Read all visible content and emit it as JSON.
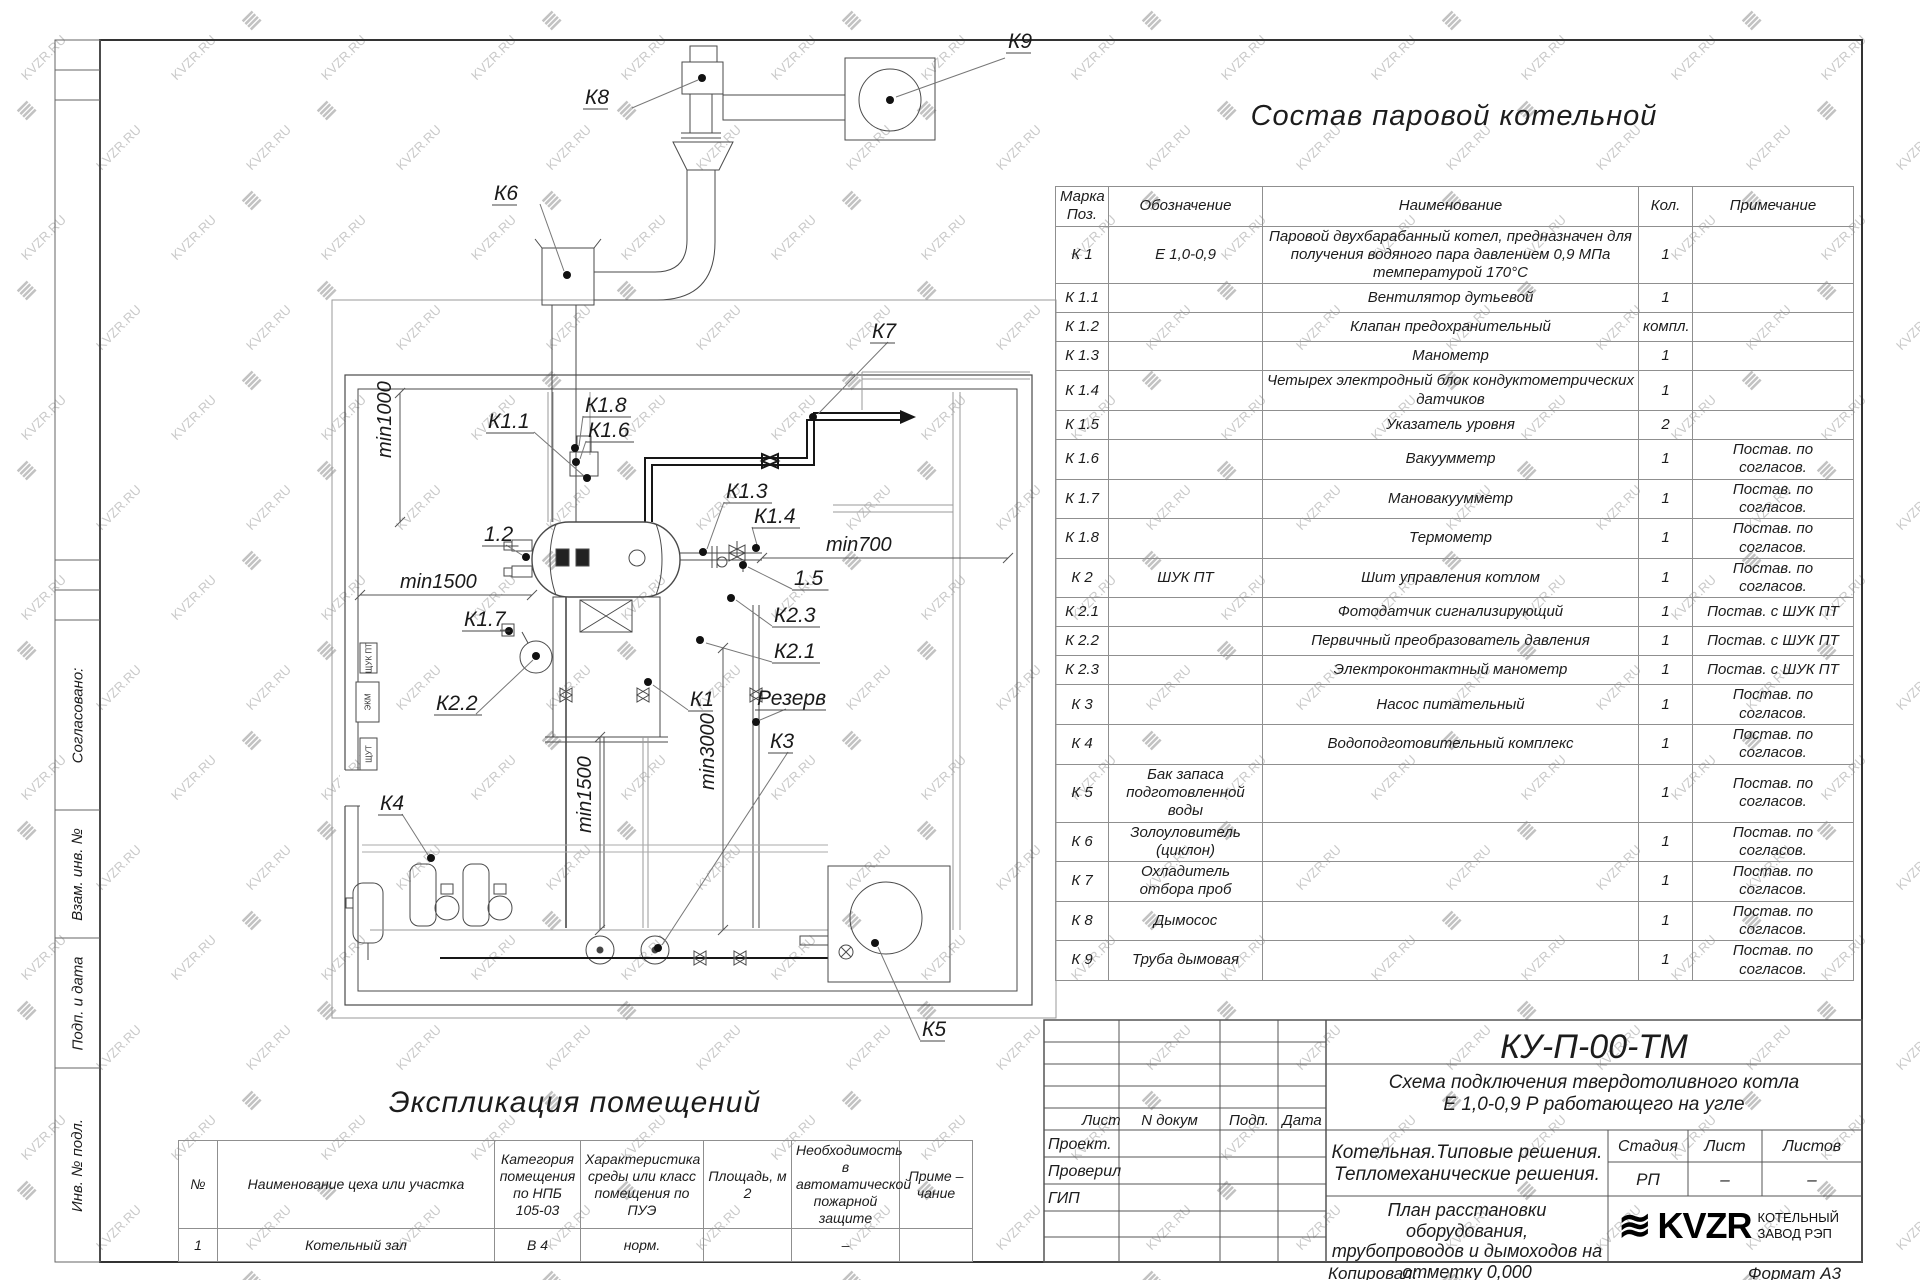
{
  "watermark": {
    "text": "KVZR.RU",
    "glyph": "≣"
  },
  "frame": {
    "left_strip": [
      {
        "label": "Согласовано:",
        "top": 620,
        "h": 190
      },
      {
        "label": "Взам. инв. №",
        "top": 810,
        "h": 128
      },
      {
        "label": "Подп. и дата",
        "top": 938,
        "h": 130
      },
      {
        "label": "Инв. № подл.",
        "top": 1068,
        "h": 194
      }
    ]
  },
  "plan": {
    "callouts": [
      {
        "label": "К9",
        "x": 1008,
        "y": 48,
        "leader": [
          [
            1005,
            58
          ],
          [
            896,
            97
          ]
        ],
        "dot": [
          890,
          100
        ]
      },
      {
        "label": "К8",
        "x": 585,
        "y": 104,
        "leader": [
          [
            632,
            108
          ],
          [
            698,
            80
          ]
        ],
        "dot": [
          702,
          78
        ]
      },
      {
        "label": "К6",
        "x": 494,
        "y": 200,
        "leader": [
          [
            540,
            204
          ],
          [
            564,
            271
          ]
        ],
        "dot": [
          567,
          275
        ]
      },
      {
        "label": "К7",
        "x": 872,
        "y": 338,
        "leader": [
          [
            888,
            342
          ],
          [
            818,
            414
          ]
        ],
        "dot": [
          813,
          417
        ]
      },
      {
        "label": "К1.8",
        "x": 585,
        "y": 412,
        "leader": [
          [
            583,
            416
          ],
          [
            579,
            446
          ]
        ],
        "dot": [
          575,
          448
        ]
      },
      {
        "label": "К1.6",
        "x": 588,
        "y": 437,
        "leader": [
          [
            586,
            441
          ],
          [
            580,
            459
          ]
        ],
        "dot": [
          576,
          462
        ]
      },
      {
        "label": "К1.1",
        "x": 488,
        "y": 428,
        "leader": [
          [
            534,
            432
          ],
          [
            584,
            476
          ]
        ],
        "dot": [
          587,
          478
        ]
      },
      {
        "label": "К1.3",
        "x": 726,
        "y": 498,
        "leader": [
          [
            724,
            502
          ],
          [
            707,
            549
          ]
        ],
        "dot": [
          703,
          552
        ]
      },
      {
        "label": "К1.4",
        "x": 754,
        "y": 523,
        "leader": [
          [
            752,
            527
          ],
          [
            757,
            545
          ]
        ],
        "dot": [
          756,
          548
        ]
      },
      {
        "label": "1.5",
        "x": 794,
        "y": 585,
        "leader": [
          [
            792,
            589
          ],
          [
            748,
            567
          ]
        ],
        "dot": [
          743,
          565
        ]
      },
      {
        "label": "К2.3",
        "x": 774,
        "y": 622,
        "leader": [
          [
            772,
            626
          ],
          [
            736,
            600
          ]
        ],
        "dot": [
          731,
          598
        ]
      },
      {
        "label": "К2.1",
        "x": 774,
        "y": 658,
        "leader": [
          [
            772,
            662
          ],
          [
            706,
            643
          ]
        ],
        "dot": [
          700,
          640
        ]
      },
      {
        "label": "1.2",
        "x": 484,
        "y": 541,
        "leader": [
          [
            506,
            545
          ],
          [
            522,
            555
          ]
        ],
        "dot": [
          526,
          557
        ]
      },
      {
        "label": "К1.7",
        "x": 464,
        "y": 626,
        "leader": [
          [
            500,
            630
          ],
          [
            506,
            630
          ]
        ],
        "dot": [
          509,
          631
        ]
      },
      {
        "label": "К2.2",
        "x": 436,
        "y": 710,
        "leader": [
          [
            476,
            714
          ],
          [
            533,
            660
          ]
        ],
        "dot": [
          536,
          656
        ]
      },
      {
        "label": "К1",
        "x": 690,
        "y": 706,
        "leader": [
          [
            688,
            710
          ],
          [
            653,
            685
          ]
        ],
        "dot": [
          648,
          682
        ]
      },
      {
        "label": "Резерв",
        "x": 757,
        "y": 705,
        "leader": [
          [
            786,
            709
          ],
          [
            760,
            720
          ]
        ],
        "dot": [
          756,
          722
        ]
      },
      {
        "label": "К3",
        "x": 770,
        "y": 748,
        "leader": [
          [
            788,
            752
          ],
          [
            662,
            945
          ]
        ],
        "dot": [
          658,
          948
        ]
      },
      {
        "label": "К4",
        "x": 380,
        "y": 810,
        "leader": [
          [
            402,
            814
          ],
          [
            428,
            855
          ]
        ],
        "dot": [
          431,
          858
        ]
      },
      {
        "label": "К5",
        "x": 922,
        "y": 1036,
        "leader": [
          [
            920,
            1040
          ],
          [
            878,
            947
          ]
        ],
        "dot": [
          875,
          943
        ]
      }
    ],
    "dimensions": [
      {
        "label": "min1000",
        "x1": 400,
        "y1": 393,
        "x2": 400,
        "y2": 522,
        "vertical": true,
        "lx": 391,
        "ly": 458
      },
      {
        "label": "min1500",
        "x1": 360,
        "y1": 595,
        "x2": 532,
        "y2": 595,
        "vertical": false,
        "lx": 400,
        "ly": 588
      },
      {
        "label": "min700",
        "x1": 762,
        "y1": 558,
        "x2": 1008,
        "y2": 558,
        "vertical": false,
        "lx": 826,
        "ly": 551
      },
      {
        "label": "min1500",
        "x1": 600,
        "y1": 737,
        "x2": 600,
        "y2": 930,
        "vertical": true,
        "lx": 591,
        "ly": 833
      },
      {
        "label": "min3000",
        "x1": 723,
        "y1": 648,
        "x2": 723,
        "y2": 930,
        "vertical": true,
        "lx": 714,
        "ly": 790
      }
    ],
    "wall_boxes": [
      {
        "label": "ЩУК ПТ",
        "x": 360,
        "y": 643,
        "w": 17,
        "h": 30
      },
      {
        "label": "ЭКМ",
        "x": 356,
        "y": 682,
        "w": 23,
        "h": 40
      },
      {
        "label": "ЩУТ",
        "x": 360,
        "y": 738,
        "w": 17,
        "h": 32
      }
    ]
  },
  "parts_table": {
    "title": "Состав паровой котельной",
    "columns": [
      "Марка\nПоз.",
      "Обозначение",
      "Наименование",
      "Кол.",
      "Примечание"
    ],
    "rows": [
      [
        "К 1",
        "Е  1,0-0,9",
        "Паровой двухбарабанный котел, предназначен для получения водяного пара давлением 0,9 МПа температурой 170°С",
        "1",
        ""
      ],
      [
        "К 1.1",
        "",
        "Вентилятор дутьевой",
        "1",
        ""
      ],
      [
        "К 1.2",
        "",
        "Клапан предохранительный",
        "компл.",
        ""
      ],
      [
        "К 1.3",
        "",
        "Манометр",
        "1",
        ""
      ],
      [
        "К 1.4",
        "",
        "Четырех электродный блок кондуктометрических датчиков",
        "1",
        ""
      ],
      [
        "К 1.5",
        "",
        "Указатель уровня",
        "2",
        ""
      ],
      [
        "К 1.6",
        "",
        "Вакуумметр",
        "1",
        "Постав. по согласов."
      ],
      [
        "К 1.7",
        "",
        "Мановакуумметр",
        "1",
        "Постав. по согласов."
      ],
      [
        "К 1.8",
        "",
        "Термометр",
        "1",
        "Постав. по согласов."
      ],
      [
        "К 2",
        "ШУК ПТ",
        "Шит управления котлом",
        "1",
        "Постав. по согласов."
      ],
      [
        "К 2.1",
        "",
        "Фотодатчик сигнализирующий",
        "1",
        "Постав. с ШУК ПТ"
      ],
      [
        "К 2.2",
        "",
        "Первичный преобразователь давления",
        "1",
        "Постав. с ШУК ПТ"
      ],
      [
        "К 2.3",
        "",
        "Электроконтактный манометр",
        "1",
        "Постав. с ШУК ПТ"
      ],
      [
        "К 3",
        "",
        "Насос питательный",
        "1",
        "Постав. по согласов."
      ],
      [
        "К 4",
        "",
        "Водоподготовительный комплекс",
        "1",
        "Постав. по согласов."
      ],
      [
        "К 5",
        "Бак запаса подготовленной воды",
        "",
        "1",
        "Постав. по согласов."
      ],
      [
        "К 6",
        "Золоуловитель  (циклон)",
        "",
        "1",
        "Постав. по согласов."
      ],
      [
        "К 7",
        "Охладитель отбора проб",
        "",
        "1",
        "Постав. по согласов."
      ],
      [
        "К 8",
        "Дымосос",
        "",
        "1",
        "Постав. по согласов."
      ],
      [
        "К 9",
        "Труба дымовая",
        "",
        "1",
        "Постав. по согласов."
      ]
    ]
  },
  "rooms_table": {
    "title": "Экспликация помещений",
    "columns": [
      "№",
      "Наименование цеха или участка",
      "Категория помещения по НПБ 105-03",
      "Характеристика среды или класс помещения по ПУЭ",
      "Площадь, м 2",
      "Необходимость в автоматической пожарной защите",
      "Приме – чание"
    ],
    "rows": [
      [
        "1",
        "Котельный зал",
        "В 4",
        "норм.",
        "",
        "–",
        ""
      ]
    ]
  },
  "title_block": {
    "code": "КУ-П-00-ТМ",
    "subtitle_lines": [
      "Схема подключения твердотоливного котла",
      "Е 1,0-0,9 Р работающего на угле"
    ],
    "header_cells": [
      "Лист",
      "N докум",
      "Подп.",
      "Дата"
    ],
    "roles": [
      "Проект.",
      "Проверил",
      "ГИП"
    ],
    "project_lines": [
      "Котельная.Типовые решения.",
      "Тепломеханические решения."
    ],
    "sheet_title_lines": [
      "План расстановки оборудования,",
      "трубопроводов и дымоходов на",
      "отметку 0,000"
    ],
    "stage_header": [
      "Стадия",
      "Лист",
      "Листов"
    ],
    "stage_values": [
      "РП",
      "–",
      "–"
    ],
    "logo_text": "KVZR",
    "company_lines": [
      "КОТЕЛЬНЫЙ",
      "ЗАВОД РЭП"
    ],
    "copied_label": "Копировал:",
    "format_label": "Формат А3"
  }
}
